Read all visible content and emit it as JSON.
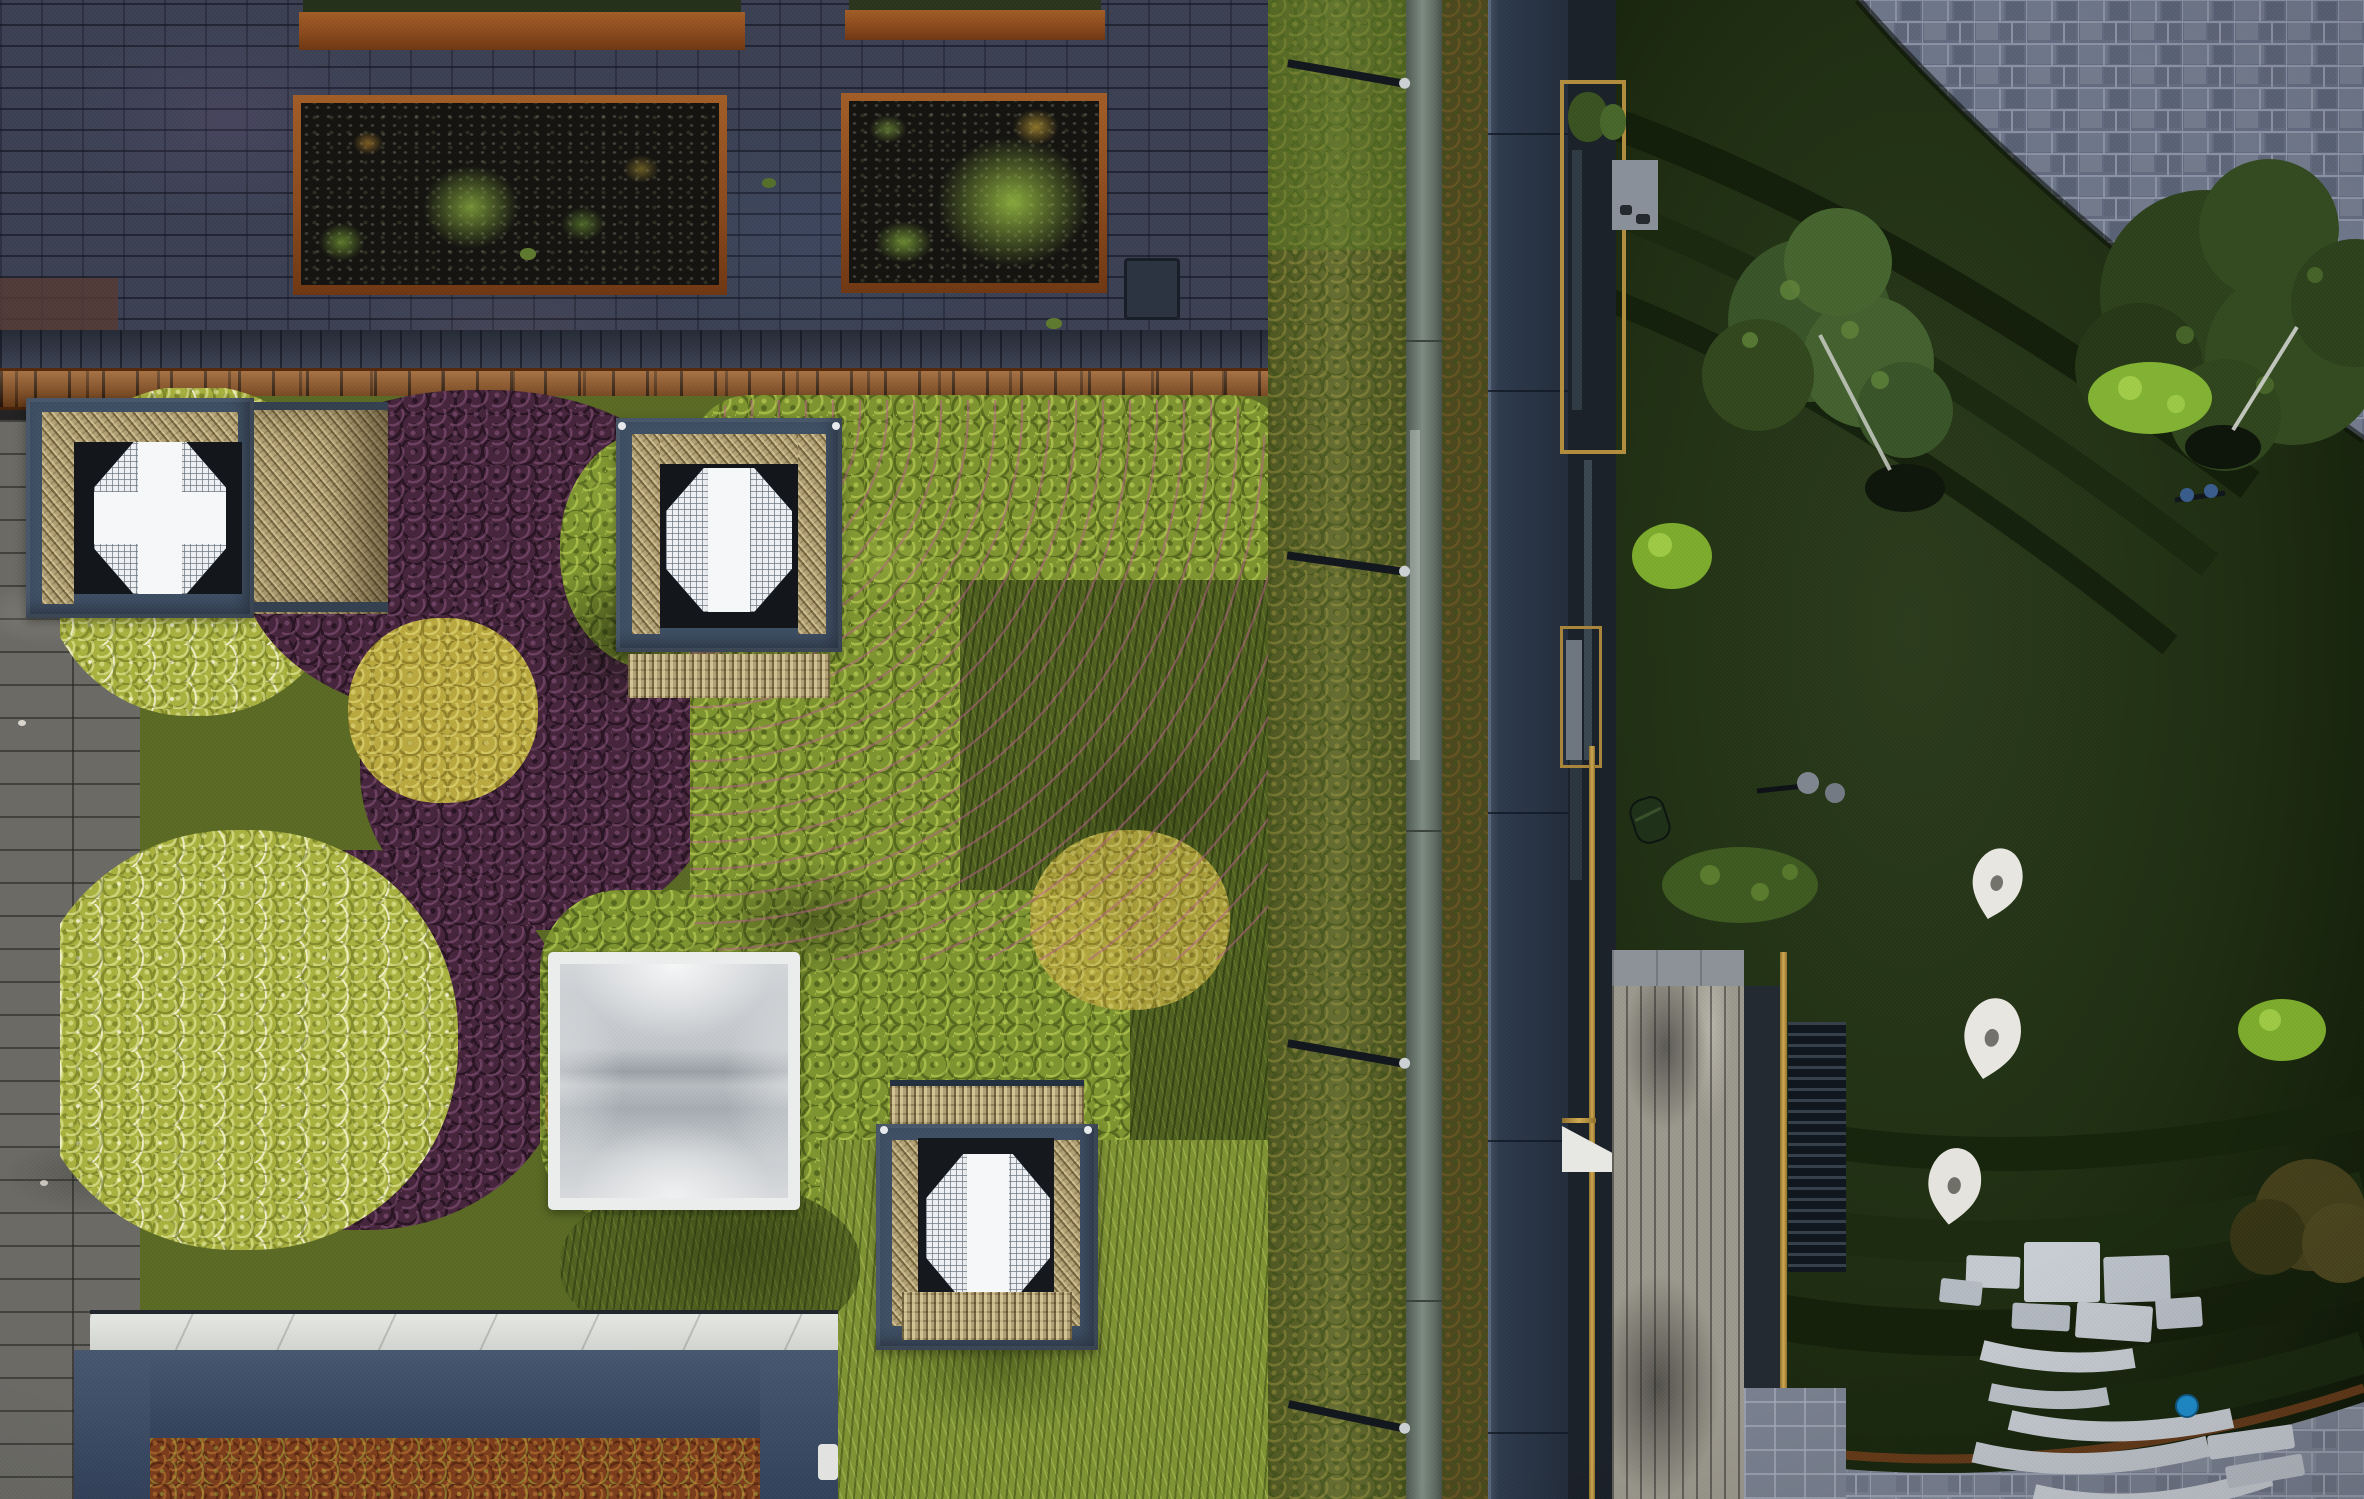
{
  "meta": {
    "image_type": "aerial drone photograph, top-down",
    "subject": "Rooftop sedum garden with ventilation cubes and skylight beside a sunken courtyard lawn with amphitheater seating",
    "visible_text": "none",
    "lighting": "dusk / overcast; rooftop bright, courtyard in deep shadow"
  },
  "palette": {
    "brick_paving": "#3b4153",
    "brick_purple_tint": "#6a5680",
    "corten_steel": "#8a4a1d",
    "corten_ruler_band": "#8f5120",
    "planter_soil": "#141310",
    "wood_deck_grey": "#6b6a65",
    "purple_sedum": "#46253c",
    "geranium_green": "#7e9430",
    "yellow_shrub": "#a9b240",
    "wild_grass": "#7f9334",
    "moss_grass": "#4f6020",
    "sedum_border": "#5d6627",
    "glass_balustrade": "#7e8b82",
    "roof_edge_navy": "#2d3a4d",
    "cube_frame_navy": "#3e4e63",
    "wicker": "#b3a176",
    "vent_white": "#f7f8fa",
    "skylight_white": "#eceeee",
    "pavilion_coping": "#e6e8e4",
    "red_sedum_roof": "#7c3d1c",
    "gold_trim": "#d0aa50",
    "lawn_dark_green": "#1f2e12",
    "hedge_arc": "#131e0b",
    "stone_paving": "#6e7689",
    "stone_slab": "#c8cdd3",
    "teardrop_sculpture": "#e9e7e1",
    "blue_object": "#1f8fd0",
    "bright_shrub": "#7cab2c"
  },
  "scene": {
    "regions": {
      "brick_paving": {
        "label": "dark blue-grey clay brick rooftop paving"
      },
      "corten_ruler": {
        "label": "corten steel slotted edge band"
      },
      "planter_top_left": {
        "label": "corten raised planter (top, partially out of frame)"
      },
      "planter_top_right": {
        "label": "corten raised planter (top right, partially out of frame)"
      },
      "planter_bed_left": {
        "label": "corten raised bed with gravel and young grasses"
      },
      "planter_bed_right": {
        "label": "corten raised bed with bright grass tufts"
      },
      "access_hatch": {
        "label": "dark service hatch on paving"
      },
      "wood_deck": {
        "label": "weathered grey timber deck walkway"
      },
      "purple_sedum": {
        "label": "deep purple heuchera / sedum ground cover"
      },
      "yellow_shrubs": {
        "label": "yellow-green shrubs with tiny white flowers"
      },
      "geranium_field": {
        "label": "bright green geranium carpet with pink blossoms"
      },
      "moss_grass": {
        "label": "mossy wild grass strip"
      },
      "wild_grass": {
        "label": "tussocky wild grass (lower roof meadow)"
      },
      "sedum_border_left": {
        "label": "mixed sedum border beside balustrade"
      },
      "sedum_border_right": {
        "label": "brown-green sedum gutter strip"
      },
      "glass_balustrade": {
        "label": "glass balustrade seen edge-on"
      },
      "glass_bracket": {
        "label": "steel balustrade support bracket"
      },
      "roof_edge_band": {
        "label": "navy roof edge / parapet walkway band"
      },
      "facade_strip": {
        "label": "shadowed building facade strip"
      },
      "balcony_bay": {
        "label": "recessed balcony bay with planters and furniture"
      },
      "gold_trim": {
        "label": "brass-gold balcony frame trim"
      },
      "wood_balcony": {
        "label": "timber-decked balcony terrace"
      },
      "awning": {
        "label": "white triangular awning corner"
      },
      "louvers": {
        "label": "dark louvered screen"
      },
      "balcony_paving": {
        "label": "light stone paving at balcony corner"
      },
      "pavilion_coping": {
        "label": "white stone coping of lower pavilion roof"
      },
      "pavilion_roof": {
        "label": "navy parapet of lower pavilion"
      },
      "pavilion_sedum": {
        "label": "russet sedum roof inside pavilion parapet"
      },
      "vent_cube_left": {
        "label": "wicker-clad ventilation cube (left, with white cross grille)"
      },
      "vent_cube_center": {
        "label": "wicker-clad ventilation cube (center)"
      },
      "vent_cube_bottom": {
        "label": "wicker-clad ventilation cube (bottom)"
      },
      "vent_grille": {
        "label": "octagonal white mesh vent grille"
      },
      "wicker_panel": {
        "label": "woven willow side panel"
      },
      "skylight": {
        "label": "square frosted dome skylight"
      },
      "lawn": {
        "label": "sunken courtyard lawn in shadow"
      },
      "hedge_arcs": {
        "label": "curved clipped hedge terraces"
      },
      "stone_paving_top": {
        "label": "grey stone paving, upper courtyard"
      },
      "stone_paving_bottom": {
        "label": "grey stone paving, lower courtyard"
      },
      "lawn_terraces": {
        "label": "concentric turf amphitheater terraces"
      },
      "rust_edge": {
        "label": "corten edging curve at lawn foot"
      },
      "amphitheater_slabs": {
        "label": "scattered granite slab steps (cluster of 7)"
      },
      "bench_arcs": {
        "label": "curved stone bench slabs (5 arcs)"
      },
      "blue_object": {
        "label": "small blue object left on a bench"
      },
      "teardrop_sculptures": {
        "label": "three white teardrop sculptures on lawn",
        "count": 3
      },
      "birch_tree": {
        "label": "young birch tree with pale trunk"
      },
      "large_tree": {
        "label": "large multi-stem tree, newly staked"
      },
      "autumn_shrub": {
        "label": "russet shrub at lower right"
      },
      "green_shrubs": {
        "label": "bright clipped green shrub balls"
      },
      "shrub_bed": {
        "label": "low planting bed on lawn"
      },
      "lawn_lamp": {
        "label": "double-disc courtyard lamp"
      },
      "robot_mower": {
        "label": "robotic lawn mower"
      },
      "tree_rootball": {
        "label": "tree root ball with anchor stakes"
      }
    }
  }
}
